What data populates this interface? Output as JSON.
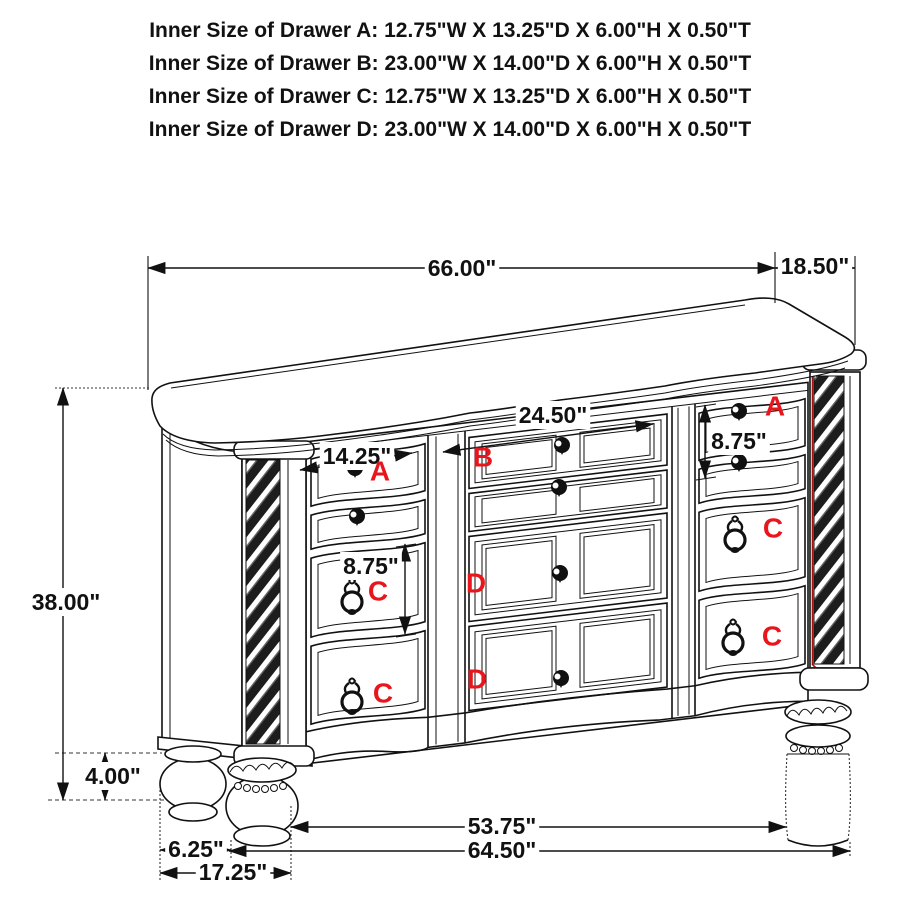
{
  "header": {
    "lines": [
      "Inner Size of Drawer A: 12.75\"W X 13.25\"D X 6.00\"H X 0.50\"T",
      "Inner Size of Drawer B: 23.00\"W X 14.00\"D X 6.00\"H X 0.50\"T",
      "Inner Size of Drawer C: 12.75\"W X 13.25\"D X 6.00\"H X 0.50\"T",
      "Inner Size of Drawer D: 23.00\"W X 14.00\"D X 6.00\"H X 0.50\"T"
    ]
  },
  "dims": {
    "top_width": "66.00\"",
    "top_depth": "18.50\"",
    "overall_height": "38.00\"",
    "foot_height": "4.00\"",
    "foot_inset": "6.25\"",
    "side_depth": "17.25\"",
    "foot_span": "53.75\"",
    "base_width": "64.50\"",
    "drawer_b_opening": "24.50\"",
    "drawer_a_opening": "14.25\"",
    "drawer_c_height": "8.75\"",
    "drawer_a_height": "8.75\""
  },
  "labels": {
    "a": "A",
    "b": "B",
    "c": "C",
    "d": "D"
  },
  "colors": {
    "line": "#111111",
    "label_red": "#e8151d",
    "column_accent_red": "#a51212",
    "background": "#ffffff"
  }
}
